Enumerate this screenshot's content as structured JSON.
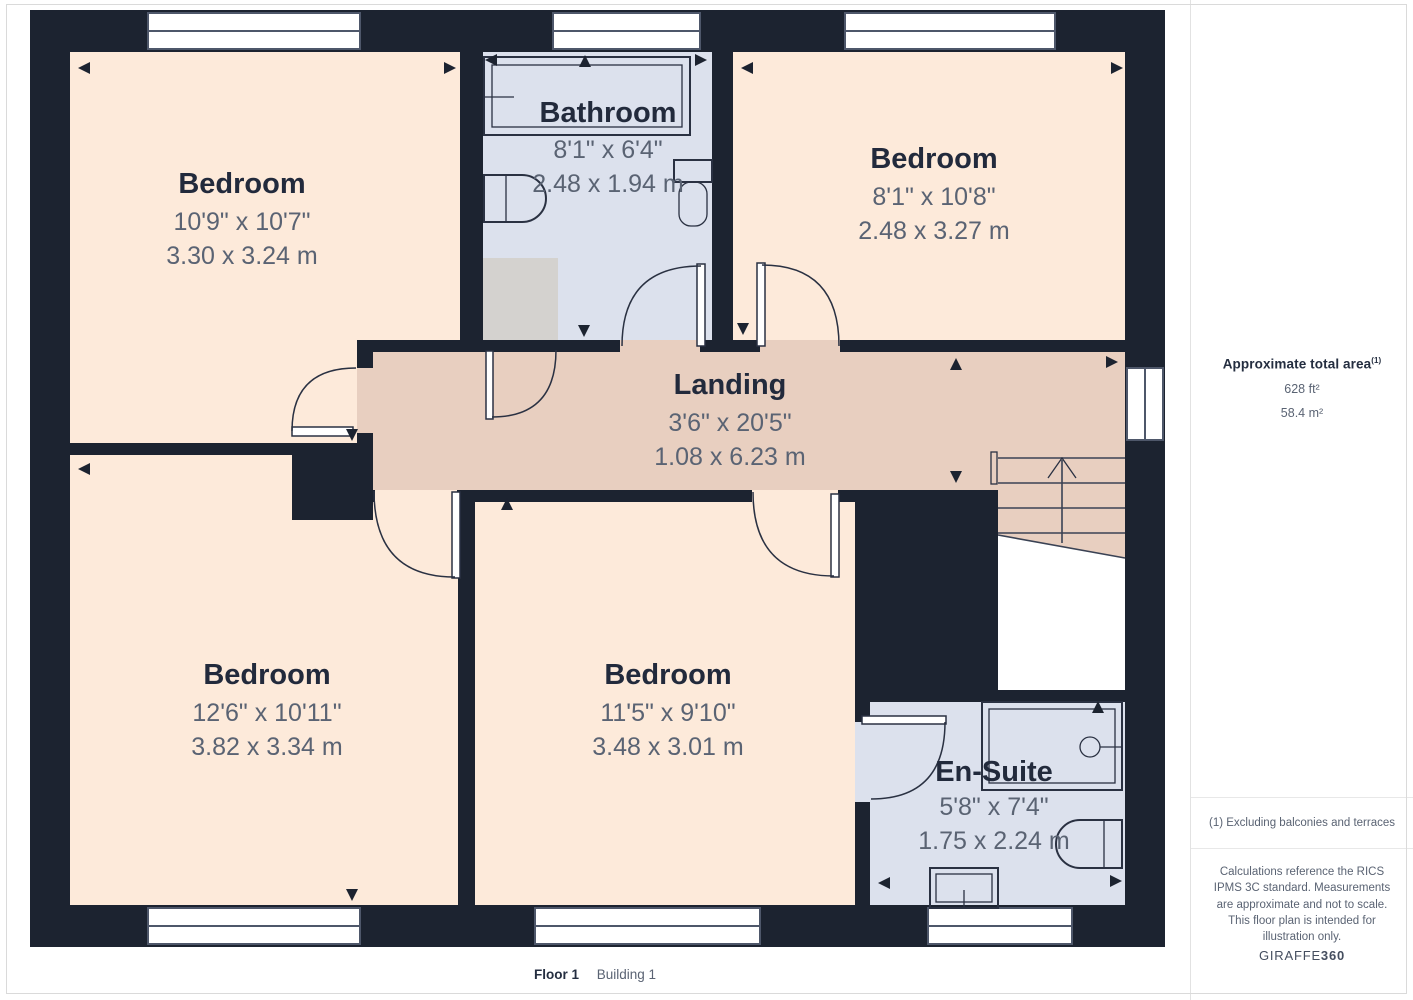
{
  "floorplan": {
    "rooms": [
      {
        "id": "bedroom-top-left",
        "name": "Bedroom",
        "dims_imperial": "10'9\" x 10'7\"",
        "dims_metric": "3.30 x 3.24 m"
      },
      {
        "id": "bathroom",
        "name": "Bathroom",
        "dims_imperial": "8'1\" x 6'4\"",
        "dims_metric": "2.48 x 1.94 m"
      },
      {
        "id": "bedroom-top-right",
        "name": "Bedroom",
        "dims_imperial": "8'1\" x 10'8\"",
        "dims_metric": "2.48 x 3.27 m"
      },
      {
        "id": "landing",
        "name": "Landing",
        "dims_imperial": "3'6\" x 20'5\"",
        "dims_metric": "1.08 x 6.23 m"
      },
      {
        "id": "bedroom-bottom-left",
        "name": "Bedroom",
        "dims_imperial": "12'6\" x 10'11\"",
        "dims_metric": "3.82 x 3.34 m"
      },
      {
        "id": "bedroom-bottom-middle",
        "name": "Bedroom",
        "dims_imperial": "11'5\" x 9'10\"",
        "dims_metric": "3.48 x 3.01 m"
      },
      {
        "id": "en-suite",
        "name": "En-Suite",
        "dims_imperial": "5'8\" x 7'4\"",
        "dims_metric": "1.75 x 2.24 m"
      }
    ],
    "colors": {
      "wall": "#1c2330",
      "bedroom_fill": "#fdeada",
      "landing_fill": "#e8cfc0",
      "wet_room_fill": "#dce1ed",
      "cupboard_fill": "#d4d2cf",
      "label_text": "#222a3c",
      "dim_text": "#5a6373"
    }
  },
  "sidebar": {
    "total_area_label": "Approximate total area",
    "total_area_superscript": "(1)",
    "area_ft": "628 ft²",
    "area_m": "58.4 m²",
    "footnote": "(1) Excluding balconies and terraces",
    "disclaimer": "Calculations reference the RICS IPMS 3C standard. Measurements are approximate and not to scale. This floor plan is intended for illustration only.",
    "brand": "GIRAFFE",
    "brand_suffix": "360"
  },
  "footer": {
    "floor_label": "Floor 1",
    "building_label": "Building 1"
  }
}
